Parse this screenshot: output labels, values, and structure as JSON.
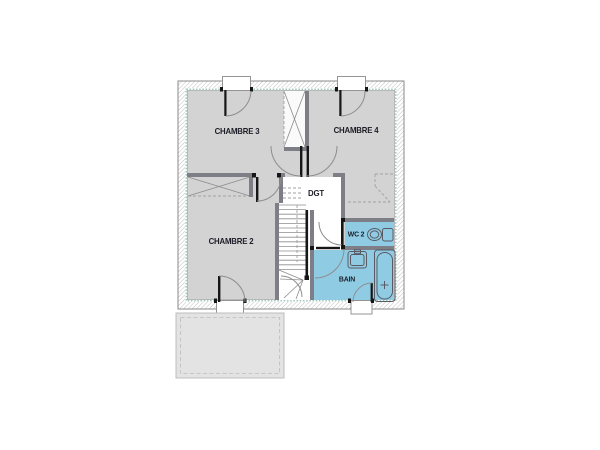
{
  "plan": {
    "type": "architectural-floor-plan",
    "floor": "upper-floor",
    "rooms": [
      {
        "id": "chambre3",
        "label": "CHAMBRE 3"
      },
      {
        "id": "chambre4",
        "label": "CHAMBRE 4"
      },
      {
        "id": "chambre2",
        "label": "CHAMBRE 2"
      },
      {
        "id": "dgt",
        "label": "DGT"
      },
      {
        "id": "wc2",
        "label": "WC 2"
      },
      {
        "id": "bain",
        "label": "BAIN"
      }
    ],
    "fixtures": [
      "toilet-icon",
      "sink-icon",
      "bathtub-icon",
      "stairs",
      "closet-top",
      "closet-left"
    ],
    "colors": {
      "room_fill": "#d3d3d3",
      "wet_room_fill": "#8fcce4",
      "insulation": "#a3c8c0",
      "wall": "#7e7e86",
      "outline": "#8a8a8a",
      "line": "#8d8d8d",
      "fixture": "#5a5a64",
      "dashed": "#a0a0a0",
      "black": "#161616",
      "text": "#1d1d28",
      "annex_fill": "#e3e3e3",
      "annex_border": "#bdbdbd"
    }
  }
}
